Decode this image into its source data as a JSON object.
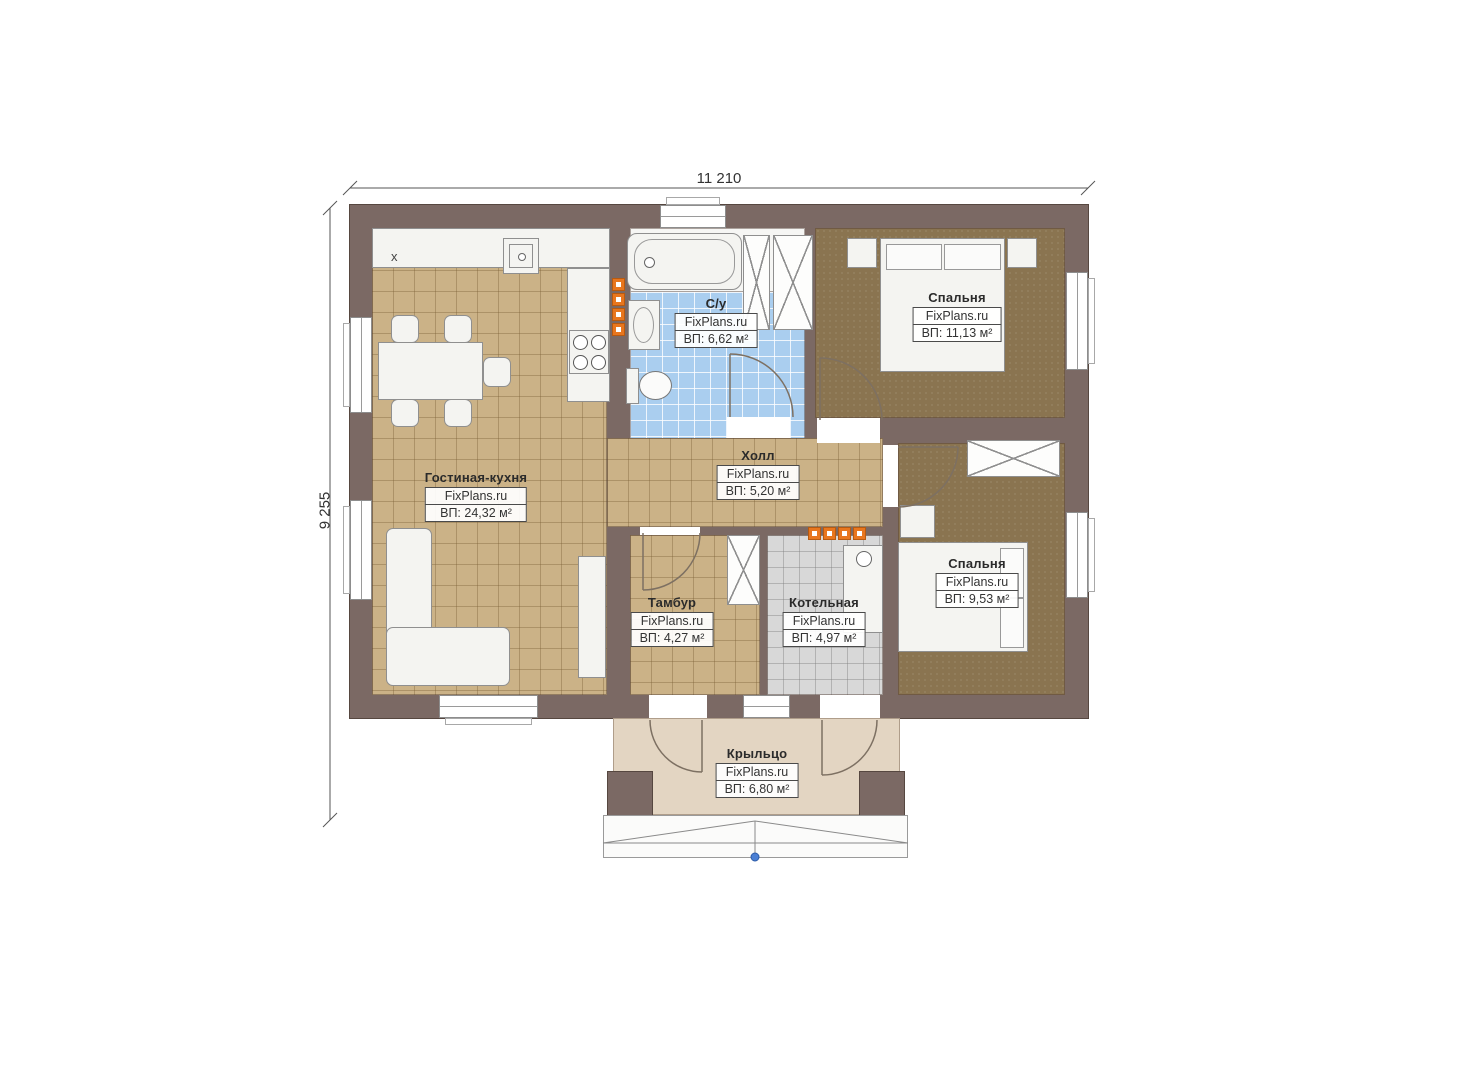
{
  "brand": {
    "label": "FixPlans.ru"
  },
  "dimensions": {
    "width": "11 210",
    "height": "9 255"
  },
  "rooms": [
    {
      "id": "living",
      "name": "Гостиная-кухня",
      "area": "ВП: 24,32 м²"
    },
    {
      "id": "bathroom",
      "name": "С/у",
      "area": "ВП: 6,62 м²"
    },
    {
      "id": "bedroom1",
      "name": "Спальня",
      "area": "ВП: 11,13 м²"
    },
    {
      "id": "hall",
      "name": "Холл",
      "area": "ВП: 5,20 м²"
    },
    {
      "id": "bedroom2",
      "name": "Спальня",
      "area": "ВП: 9,53 м²"
    },
    {
      "id": "tambour",
      "name": "Тамбур",
      "area": "ВП: 4,27 м²"
    },
    {
      "id": "boiler",
      "name": "Котельная",
      "area": "ВП: 4,97 м²"
    },
    {
      "id": "porch",
      "name": "Крыльцо",
      "area": "ВП: 6,80 м²"
    }
  ],
  "kitchen": {
    "fridge_mark": "х"
  },
  "colors": {
    "wall": "#7b6964",
    "floor_tan": "#cbb287",
    "floor_brown": "#8a7450",
    "floor_blue": "#aaceef",
    "floor_gray": "#d8d8d8",
    "porch": "#e3d5c2",
    "radiator": "#e8761e",
    "marker_blue": "#4a7fd4"
  }
}
